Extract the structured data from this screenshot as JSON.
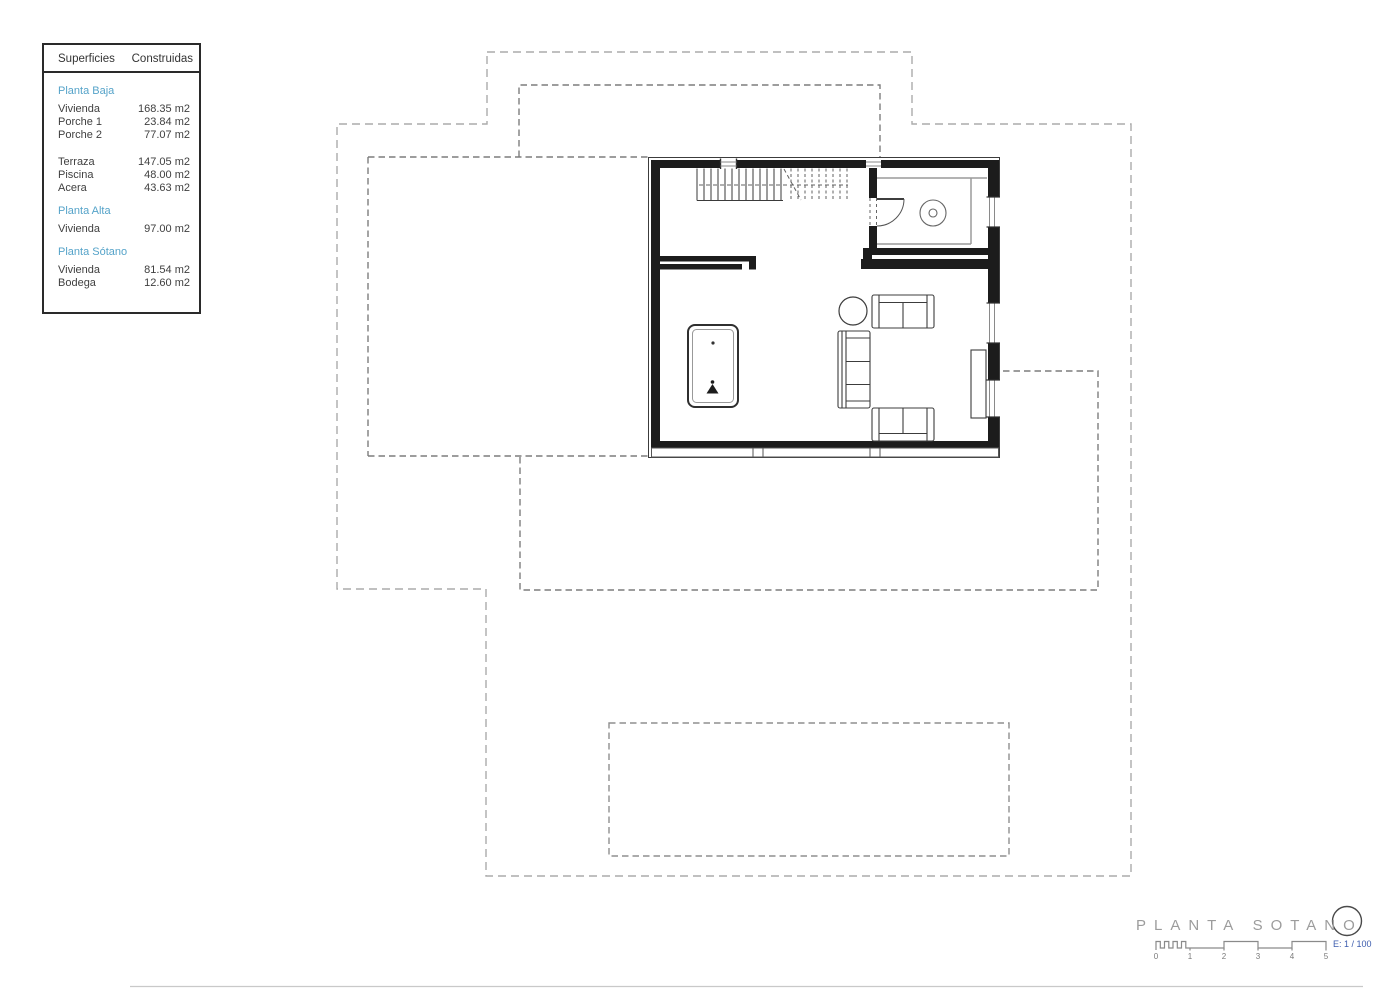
{
  "surfaces": {
    "header": {
      "col1": "Superficies",
      "col2": "Construidas"
    },
    "groups": [
      {
        "title": "Planta Baja",
        "rows": [
          {
            "label": "Vivienda",
            "value": "168.35 m2"
          },
          {
            "label": "Porche 1",
            "value": "23.84 m2"
          },
          {
            "label": "Porche 2",
            "value": "77.07 m2"
          }
        ]
      },
      {
        "title": "",
        "rows": [
          {
            "label": "Terraza",
            "value": "147.05 m2"
          },
          {
            "label": "Piscina",
            "value": "48.00 m2"
          },
          {
            "label": "Acera",
            "value": "43.63 m2"
          }
        ]
      },
      {
        "title": "Planta Alta",
        "rows": [
          {
            "label": "Vivienda",
            "value": "97.00 m2"
          }
        ]
      },
      {
        "title": "Planta Sótano",
        "rows": [
          {
            "label": "Vivienda",
            "value": "81.54 m2"
          },
          {
            "label": "Bodega",
            "value": "12.60 m2"
          }
        ]
      }
    ]
  },
  "titleblock": {
    "title": "PLANTA SOTANO",
    "scale_label": "E: 1 / 100",
    "scale_ticks": [
      "0",
      "1",
      "2",
      "3",
      "4",
      "5"
    ]
  },
  "colors": {
    "accent_teal": "#55a3c9",
    "scale_blue": "#3c5cae",
    "wall_black": "#1c1c1c",
    "dash_outer_gray": "#ababab",
    "dash_inner_gray": "#7d7d7d"
  }
}
